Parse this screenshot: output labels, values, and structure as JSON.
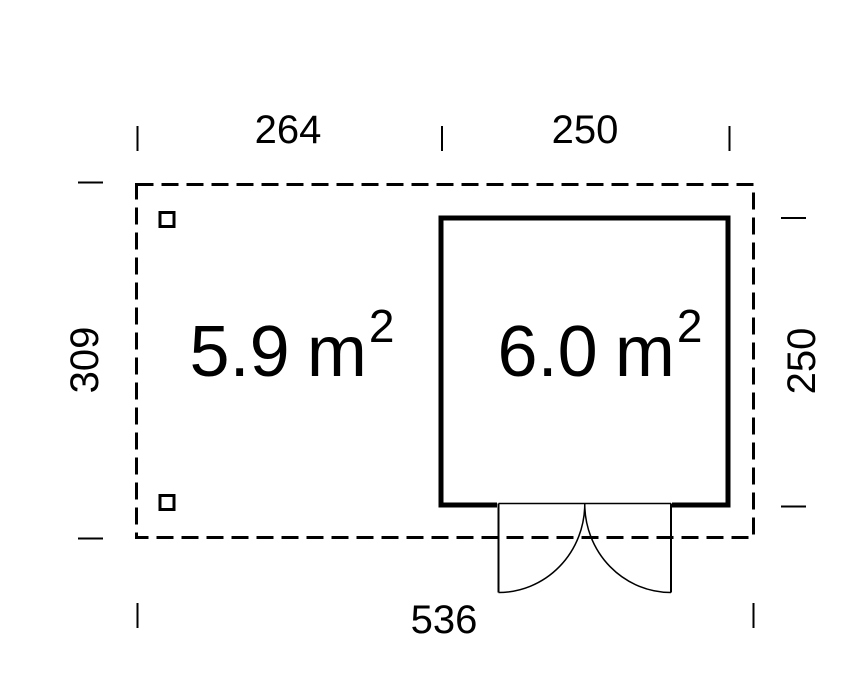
{
  "figure": {
    "background": "#ffffff",
    "line_color": "#000000",
    "areas": {
      "left": {
        "value": "5.9",
        "unit": "m",
        "exponent": "2"
      },
      "cabin": {
        "value": "6.0",
        "unit": "m",
        "exponent": "2"
      }
    },
    "dimensions": {
      "top_left_width": "264",
      "top_right_width": "250",
      "left_height": "309",
      "right_height": "250",
      "bottom_width": "536"
    }
  }
}
